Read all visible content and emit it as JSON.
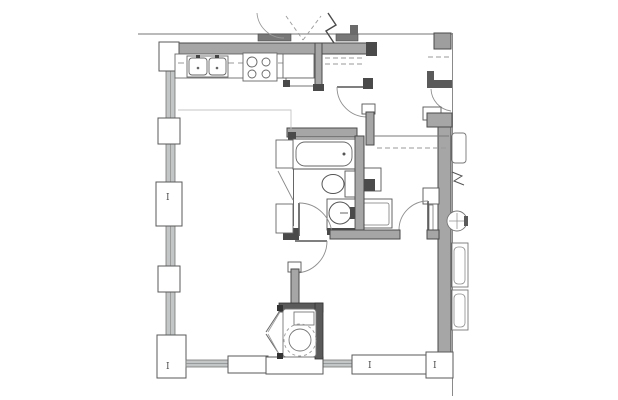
{
  "drawing": {
    "kind": "architectural-floor-plan",
    "title": "apartment unit floor plan (no printed labels)",
    "column_markers": [
      {
        "label": "I"
      },
      {
        "label": "I"
      },
      {
        "label": "I"
      },
      {
        "label": "I"
      }
    ],
    "colors": {
      "background": "#ffffff",
      "wall_fill": "#a6a6a6",
      "wall_edge": "#4a4a4a",
      "dark_wall_fill": "#5a5a5a",
      "fixture_line": "#5f5f5f",
      "door_arc": "#8f8f8f",
      "dashed_line": "#9a9a9a",
      "glazing_fill": "#c2c6c6",
      "light_outline": "#c4c4c4"
    },
    "fixtures": [
      "kitchen-double-sink",
      "range-cooktop-4-burners",
      "refrigerator",
      "entry-closet-rod-dashed",
      "bathtub",
      "toilet",
      "vanity-round-sink",
      "bedroom-closet-rod-dashed",
      "wall-niche-shelf",
      "desk-dresser",
      "washer-dryer-in-chamfered-closet",
      "adjacent-unit-lavatory",
      "adjacent-unit-toilet",
      "adjacent-unit-bathtub"
    ],
    "symbols": [
      "break-line-zigzag",
      "window-wall-mullions",
      "door-swing-arcs",
      "column-grid-markers"
    ]
  }
}
